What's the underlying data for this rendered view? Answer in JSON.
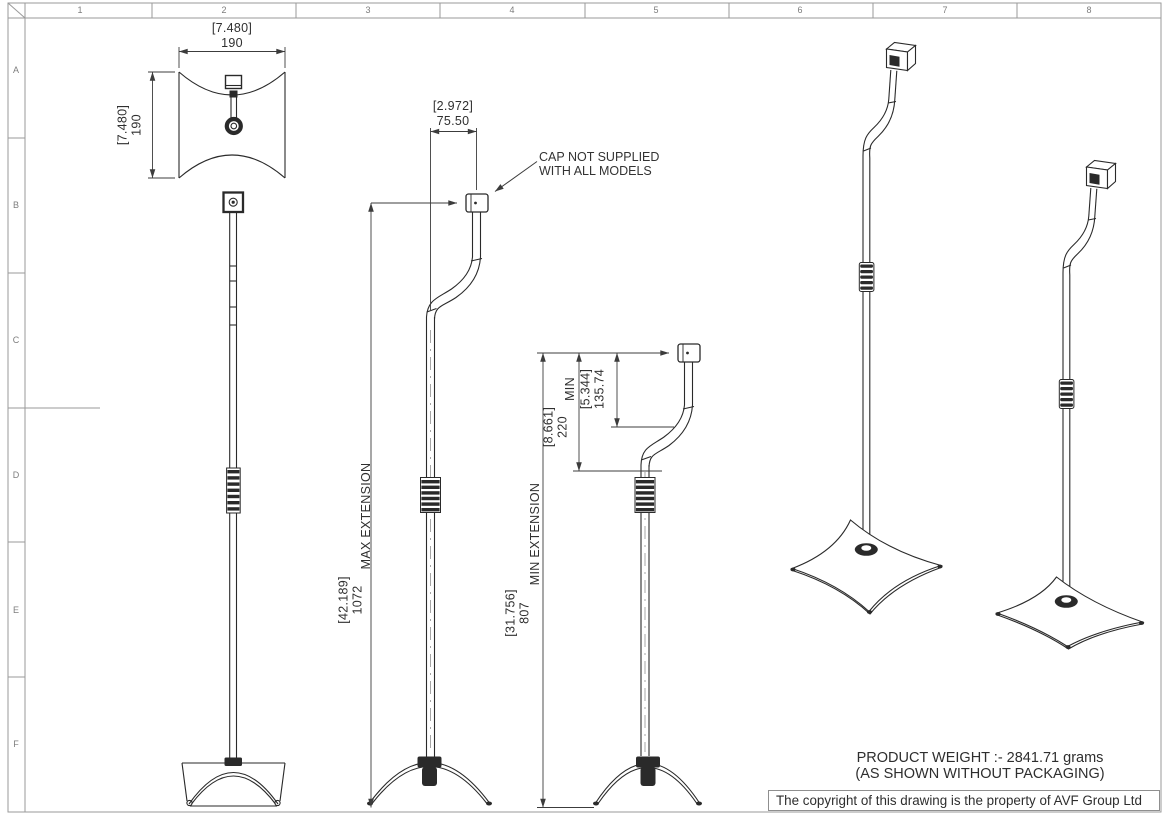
{
  "sheet": {
    "grid_columns": [
      "1",
      "2",
      "3",
      "4",
      "5",
      "6",
      "7",
      "8"
    ],
    "grid_rows": [
      "A",
      "B",
      "C",
      "D",
      "E",
      "F"
    ]
  },
  "dims": {
    "base_width": {
      "in": "[7.480]",
      "mm": "190"
    },
    "base_depth": {
      "in": "[7.480]",
      "mm": "190"
    },
    "pole_offset": {
      "in": "[2.972]",
      "mm": "75.50"
    },
    "max_ext": {
      "in": "[42.189]",
      "mm": "1072",
      "label": "MAX EXTENSION"
    },
    "min_ext": {
      "in": "[31.756]",
      "mm": "807",
      "label": "MIN EXTENSION"
    },
    "min_height": {
      "in": "[8.661]",
      "mm": "220",
      "label": "MIN"
    },
    "cap_drop": {
      "in": "[5.344]",
      "mm": "135.74"
    }
  },
  "notes": {
    "cap_line1": "CAP NOT SUPPLIED",
    "cap_line2": "WITH ALL MODELS",
    "weight_line1": "PRODUCT WEIGHT :- 2841.71 grams",
    "weight_line2": "(AS SHOWN WITHOUT PACKAGING)",
    "copyright": "The copyright of this drawing is the property of AVF Group Ltd"
  },
  "colors": {
    "line": "#2a2a2a",
    "dim": "#3c3c3c",
    "border": "#9a9a9a",
    "text": "#2f2f2f"
  }
}
